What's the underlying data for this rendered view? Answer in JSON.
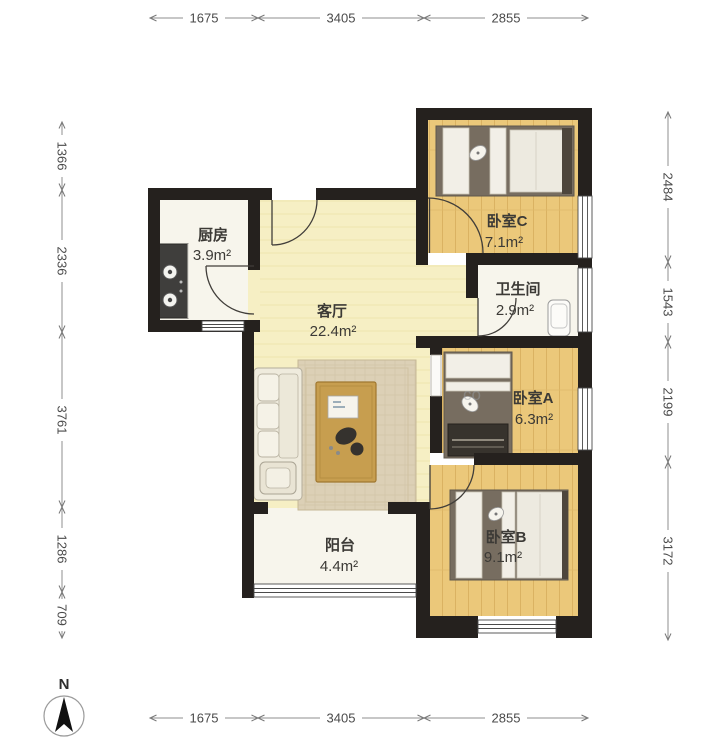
{
  "plan": {
    "rooms": {
      "kitchen": {
        "name": "厨房",
        "area": "3.9m²"
      },
      "living": {
        "name": "客厅",
        "area": "22.4m²"
      },
      "bedroom_c": {
        "name": "卧室C",
        "area": "7.1m²"
      },
      "bathroom": {
        "name": "卫生间",
        "area": "2.9m²"
      },
      "bedroom_a": {
        "name": "卧室A",
        "area": "6.3m²"
      },
      "bedroom_b": {
        "name": "卧室B",
        "area": "9.1m²"
      },
      "balcony": {
        "name": "阳台",
        "area": "4.4m²"
      }
    },
    "colors": {
      "wall": "#25211e",
      "wood_floor": "#ebc87a",
      "living_floor": "#f6efc4",
      "white_floor": "#f7f5ec"
    }
  },
  "dimensions": {
    "top": [
      "1675",
      "3405",
      "2855"
    ],
    "bottom": [
      "1675",
      "3405",
      "2855"
    ],
    "left": [
      "1366",
      "2336",
      "3761",
      "1286",
      "709"
    ],
    "right": [
      "2484",
      "1543",
      "2199",
      "3172"
    ]
  },
  "compass": {
    "north_label": "N"
  },
  "watermark": {
    "text": "co"
  }
}
